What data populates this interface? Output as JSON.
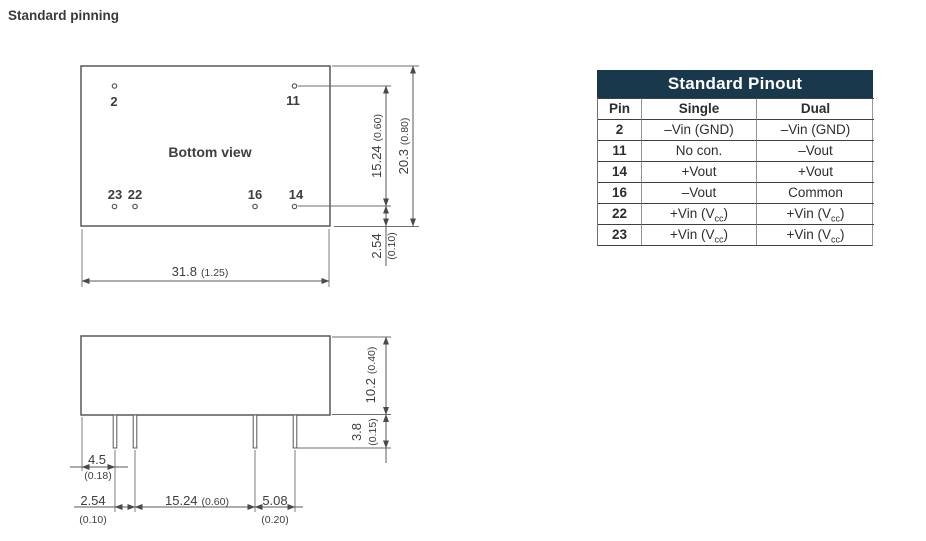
{
  "title": "Standard pinning",
  "colors": {
    "table_header_bg": "#1a384c",
    "line_gray": "#6e6e6e",
    "text_dark": "#3a3a3a"
  },
  "pinout_table": {
    "title": "Standard Pinout",
    "columns": {
      "pin": "Pin",
      "single": "Single",
      "dual": "Dual"
    },
    "rows": [
      {
        "pin": "2",
        "single": "–Vin (GND)",
        "dual": "–Vin (GND)"
      },
      {
        "pin": "11",
        "single": "No con.",
        "dual": "–Vout"
      },
      {
        "pin": "14",
        "single": "+Vout",
        "dual": "+Vout"
      },
      {
        "pin": "16",
        "single": "–Vout",
        "dual": "Common"
      },
      {
        "pin": "22",
        "single": "+Vin (Vcc)",
        "dual": "+Vin (Vcc)"
      },
      {
        "pin": "23",
        "single": "+Vin (Vcc)",
        "dual": "+Vin (Vcc)"
      }
    ]
  },
  "bottom_view": {
    "label": "Bottom view",
    "pin_labels": {
      "p2": "2",
      "p11": "11",
      "p23": "23",
      "p22": "22",
      "p16": "16",
      "p14": "14"
    },
    "dims": {
      "pin_span_v": {
        "mm": "15.24",
        "inch": "(0.60)"
      },
      "body_height": {
        "mm": "20.3",
        "inch": "(0.80)"
      },
      "pin_offset": {
        "mm": "2.54",
        "inch": "(0.10)"
      },
      "body_width": {
        "mm": "31.8",
        "inch": "(1.25)"
      }
    }
  },
  "side_view": {
    "dims": {
      "case_height": {
        "mm": "10.2",
        "inch": "(0.40)"
      },
      "pin_length": {
        "mm": "3.8",
        "inch": "(0.15)"
      },
      "edge_to_pin": {
        "mm": "4.5",
        "inch": "(0.18)"
      },
      "pitch_small": {
        "mm": "2.54",
        "inch": "(0.10)"
      },
      "pitch_large": {
        "mm": "15.24",
        "inch": "(0.60)"
      },
      "pitch_mid": {
        "mm": "5.08",
        "inch": "(0.20)"
      }
    }
  }
}
